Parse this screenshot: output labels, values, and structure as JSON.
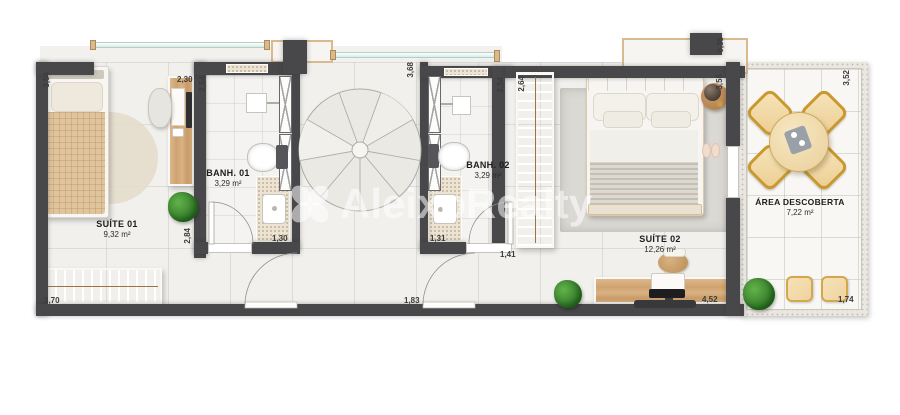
{
  "watermark": {
    "brand": "AleixoRealty"
  },
  "rooms": {
    "suite01": {
      "name": "SUÍTE 01",
      "area": "9,32 m²"
    },
    "banh01": {
      "name": "BANH. 01",
      "area": "3,29 m²"
    },
    "banh02": {
      "name": "BANH. 02",
      "area": "3,29 m²"
    },
    "suite02": {
      "name": "SUÍTE 02",
      "area": "12,26 m²"
    },
    "area_descoberta": {
      "name": "ÁREA DESCOBERTA",
      "area": "7,22 m²"
    }
  },
  "dimensions": {
    "suite01_side": "3,54",
    "suite01_desk": "2,30",
    "banh01_depth": "2,54",
    "suite01_wall": "2,84",
    "banh01_width": "1,30",
    "suite01_wardrobe": "3,70",
    "stair_void": "3,68",
    "banh02_width": "1,31",
    "banh02_door": "1,41",
    "banh02_depth": "2,54",
    "closet_depth": "2,64",
    "hall_door": "1,83",
    "suite02_desk": "4,52",
    "column_top": "0,35",
    "suite02_side": "3,55",
    "deck_side": "3,52",
    "deck_bottom": "1,74"
  },
  "colors": {
    "wall": "#48484a",
    "wood": "#d3ab7b",
    "floor": "#f1f0ed",
    "deck_floor": "#f8f7f4",
    "glass_rail": "#bfe0d8",
    "rug": "#dbd9d4",
    "plant": "#3f8c34",
    "granite": "#ece3d2",
    "label": "#1d1d1d"
  }
}
